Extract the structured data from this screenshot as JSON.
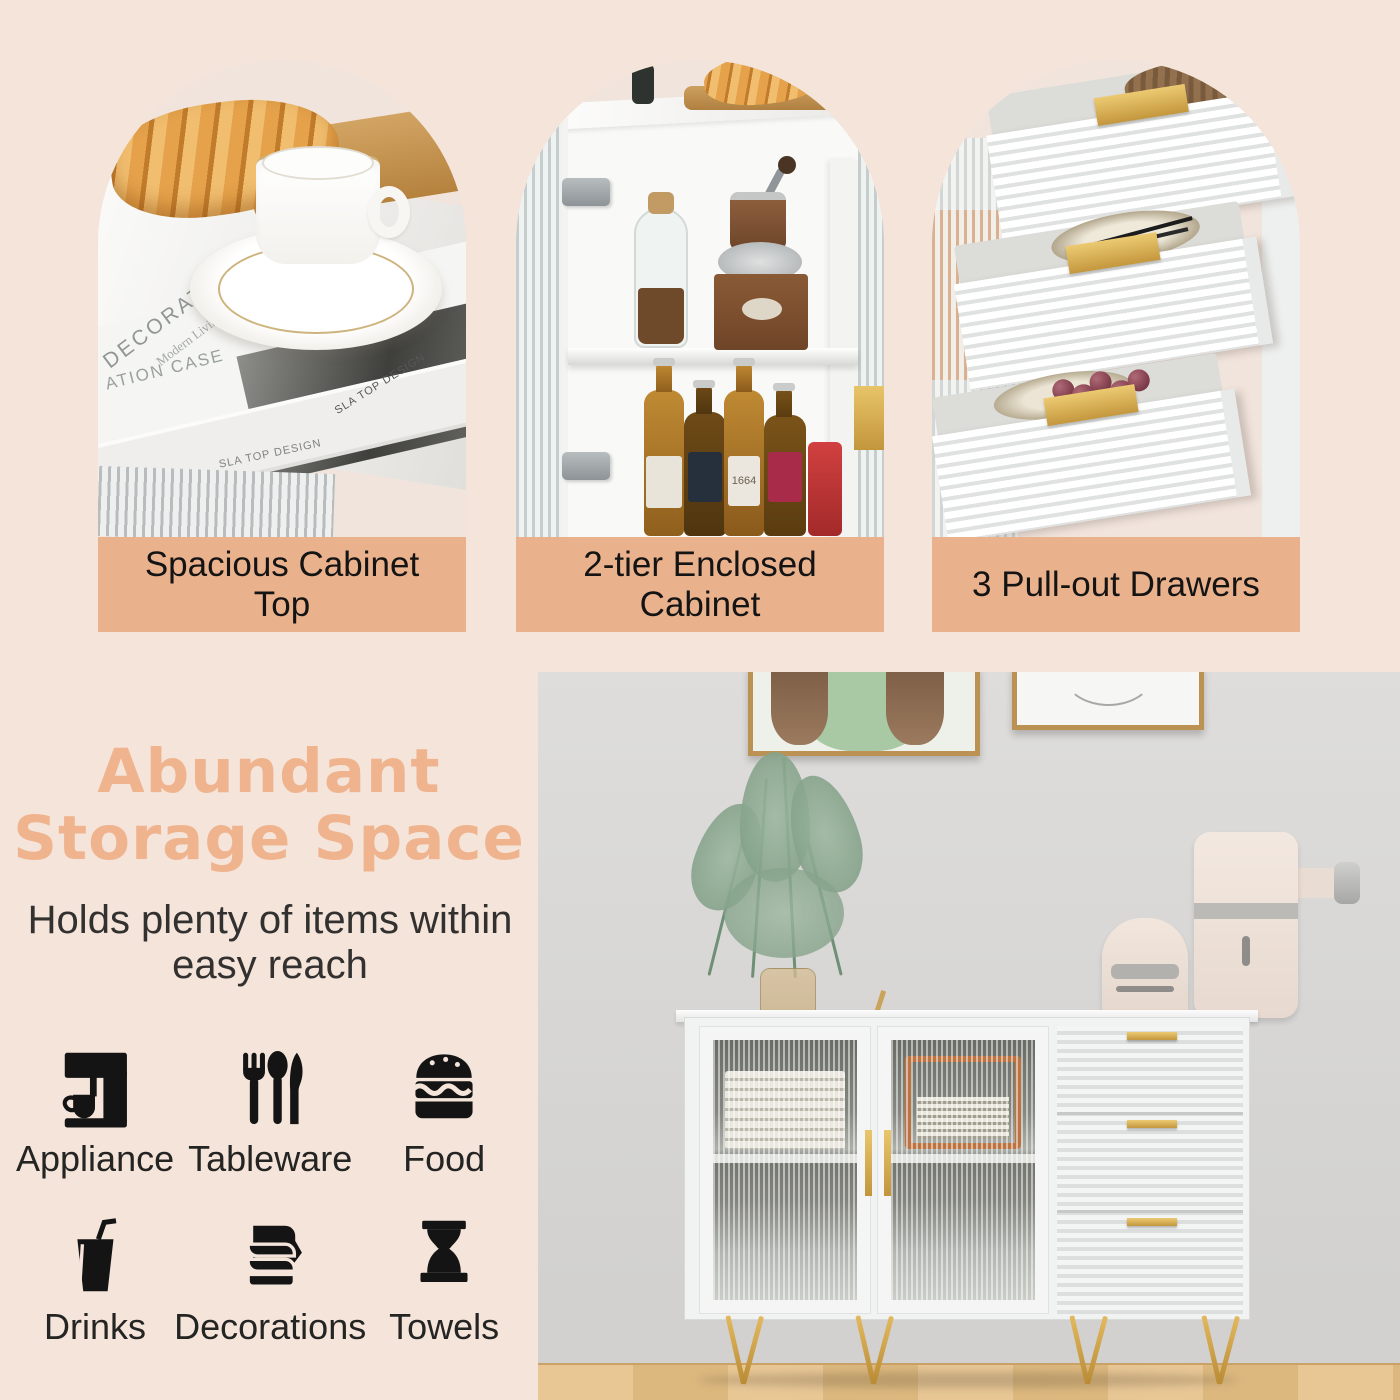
{
  "features": [
    {
      "caption": "Spacious Cabinet Top",
      "photo": {
        "book_cover_title": "DECORATION CASE",
        "book_cover_subtitle": "Modern Living",
        "book_side_text": "ATION CASE",
        "book_spine_text": "SLA TOP DESIGN",
        "book_top_text": "SLA TOP DESIGN"
      }
    },
    {
      "caption": "2-tier Enclosed Cabinet",
      "photo": {
        "bottle_label": "1664"
      }
    },
    {
      "caption": "3 Pull-out Drawers",
      "photo": {}
    }
  ],
  "storage_section": {
    "title": "Abundant Storage Space",
    "subtitle": "Holds plenty of items within easy reach",
    "items": [
      {
        "label": "Appliance",
        "icon": "appliance-icon"
      },
      {
        "label": "Tableware",
        "icon": "tableware-icon"
      },
      {
        "label": "Food",
        "icon": "food-icon"
      },
      {
        "label": "Drinks",
        "icon": "drinks-icon"
      },
      {
        "label": "Decorations",
        "icon": "decorations-icon"
      },
      {
        "label": "Towels",
        "icon": "towels-icon"
      }
    ]
  },
  "colors": {
    "page_background": "#f4e4da",
    "caption_bar": "#eab18d",
    "heading_text": "#efb48e",
    "body_text": "#2c2b29",
    "icon_color": "#141414",
    "gold_accent": "#d3a757"
  }
}
